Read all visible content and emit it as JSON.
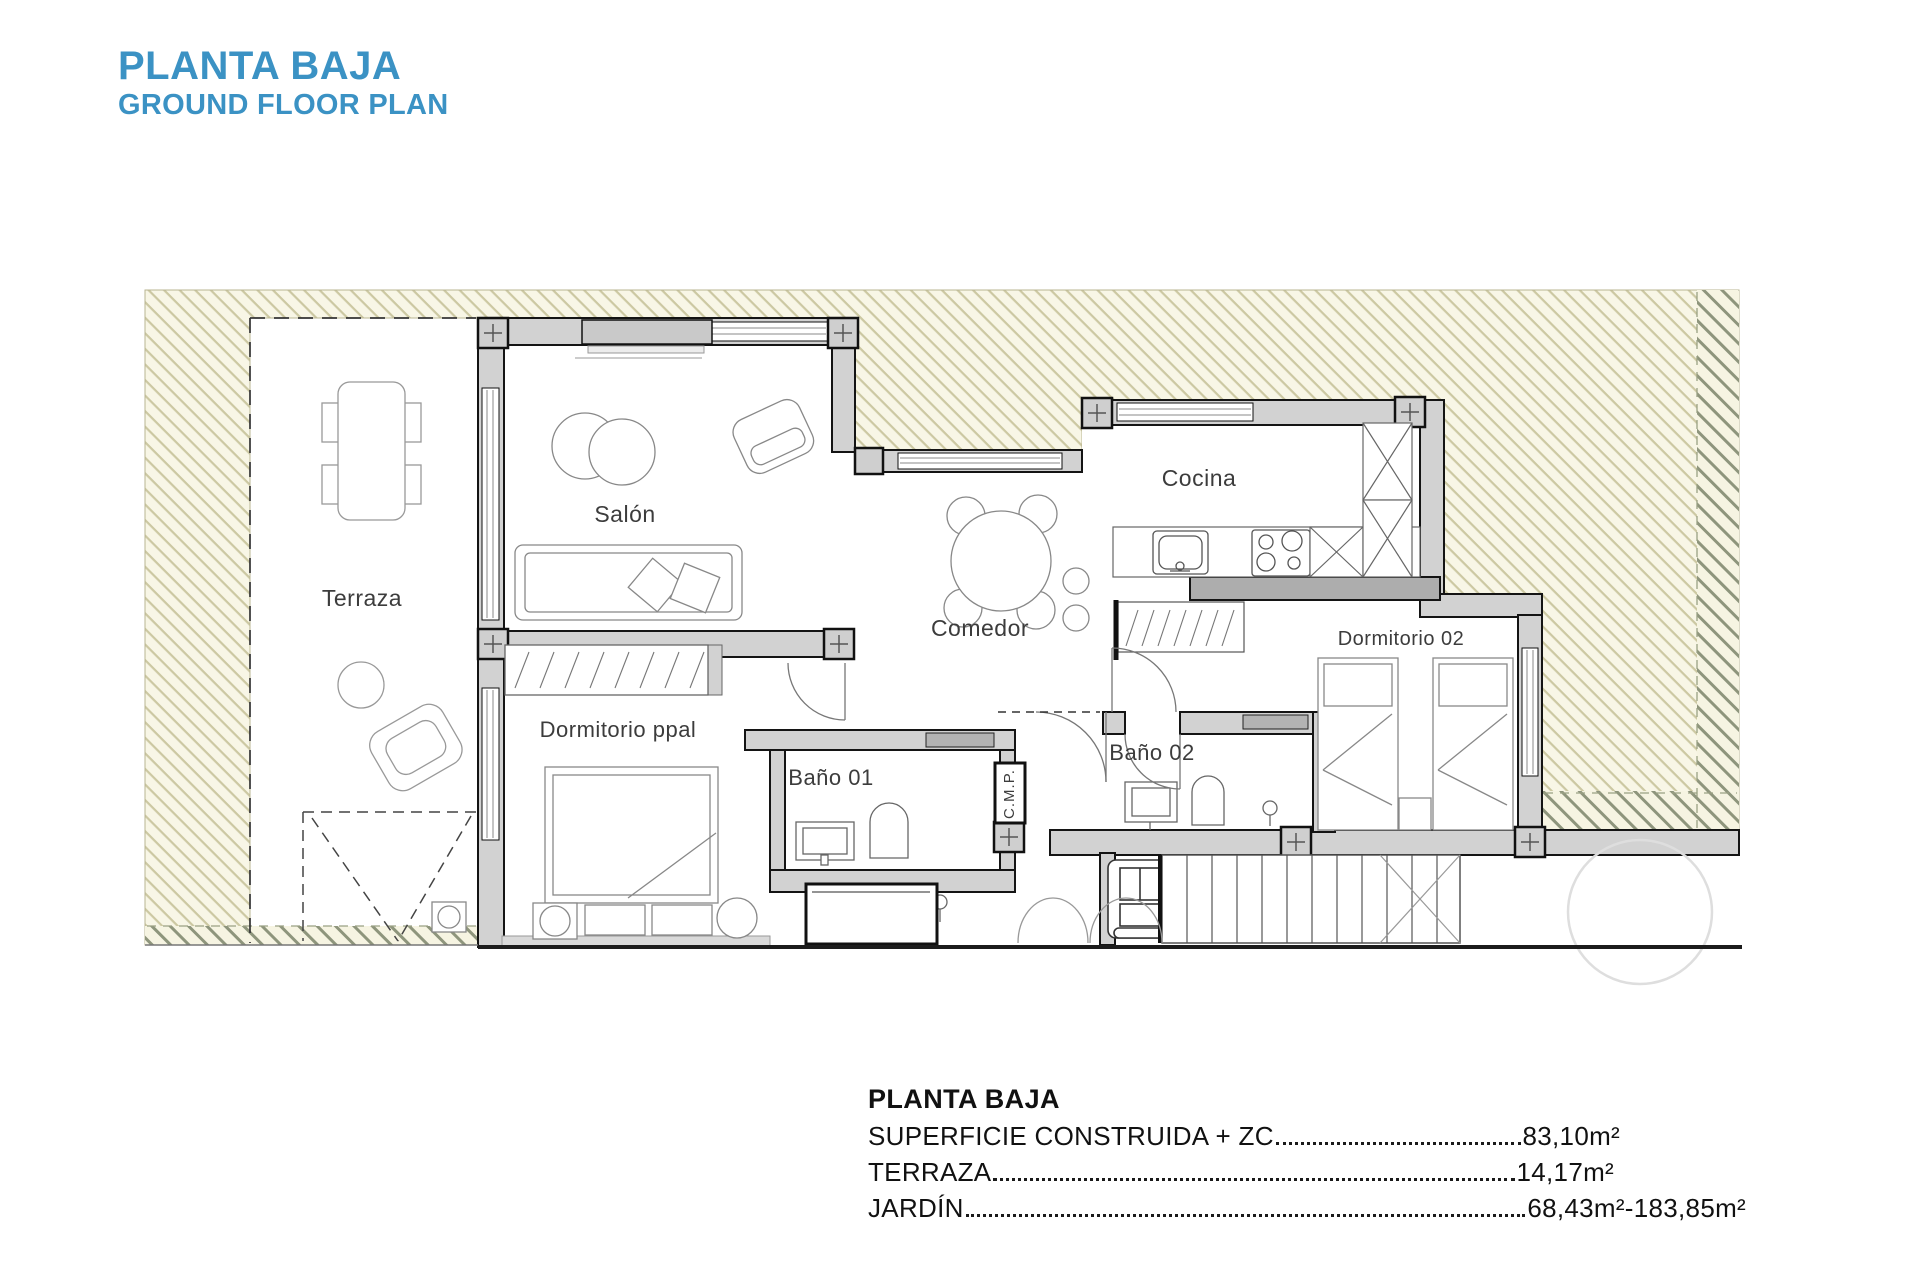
{
  "header": {
    "title": "PLANTA BAJA",
    "subtitle": "GROUND FLOOR PLAN"
  },
  "plan": {
    "rooms": {
      "terraza": "Terraza",
      "salon": "Salón",
      "cocina": "Cocina",
      "comedor": "Comedor",
      "dormitorio_ppal": "Dormitorio ppal",
      "bano_01": "Baño 01",
      "bano_02": "Baño 02",
      "dormitorio_02": "Dormitorio 02",
      "cmp": "C.M.P."
    }
  },
  "summary": {
    "heading": "PLANTA BAJA",
    "rows": [
      {
        "label": "SUPERFICIE CONSTRUIDA + ZC",
        "value": "83,10m²"
      },
      {
        "label": "TERRAZA",
        "value": "14,17m²"
      },
      {
        "label": "JARDÍN",
        "value": "68,43m²-183,85m²"
      }
    ]
  },
  "colors": {
    "accent_blue": "#3b92c4",
    "hatch_background": "#f8f6e6",
    "hatch_line_light": "#ccc8a2",
    "hatch_line_dark": "#8e957c",
    "wall_fill": "#d2d2d2",
    "wall_outline": "#141414",
    "label_text": "#3c3c3c"
  }
}
